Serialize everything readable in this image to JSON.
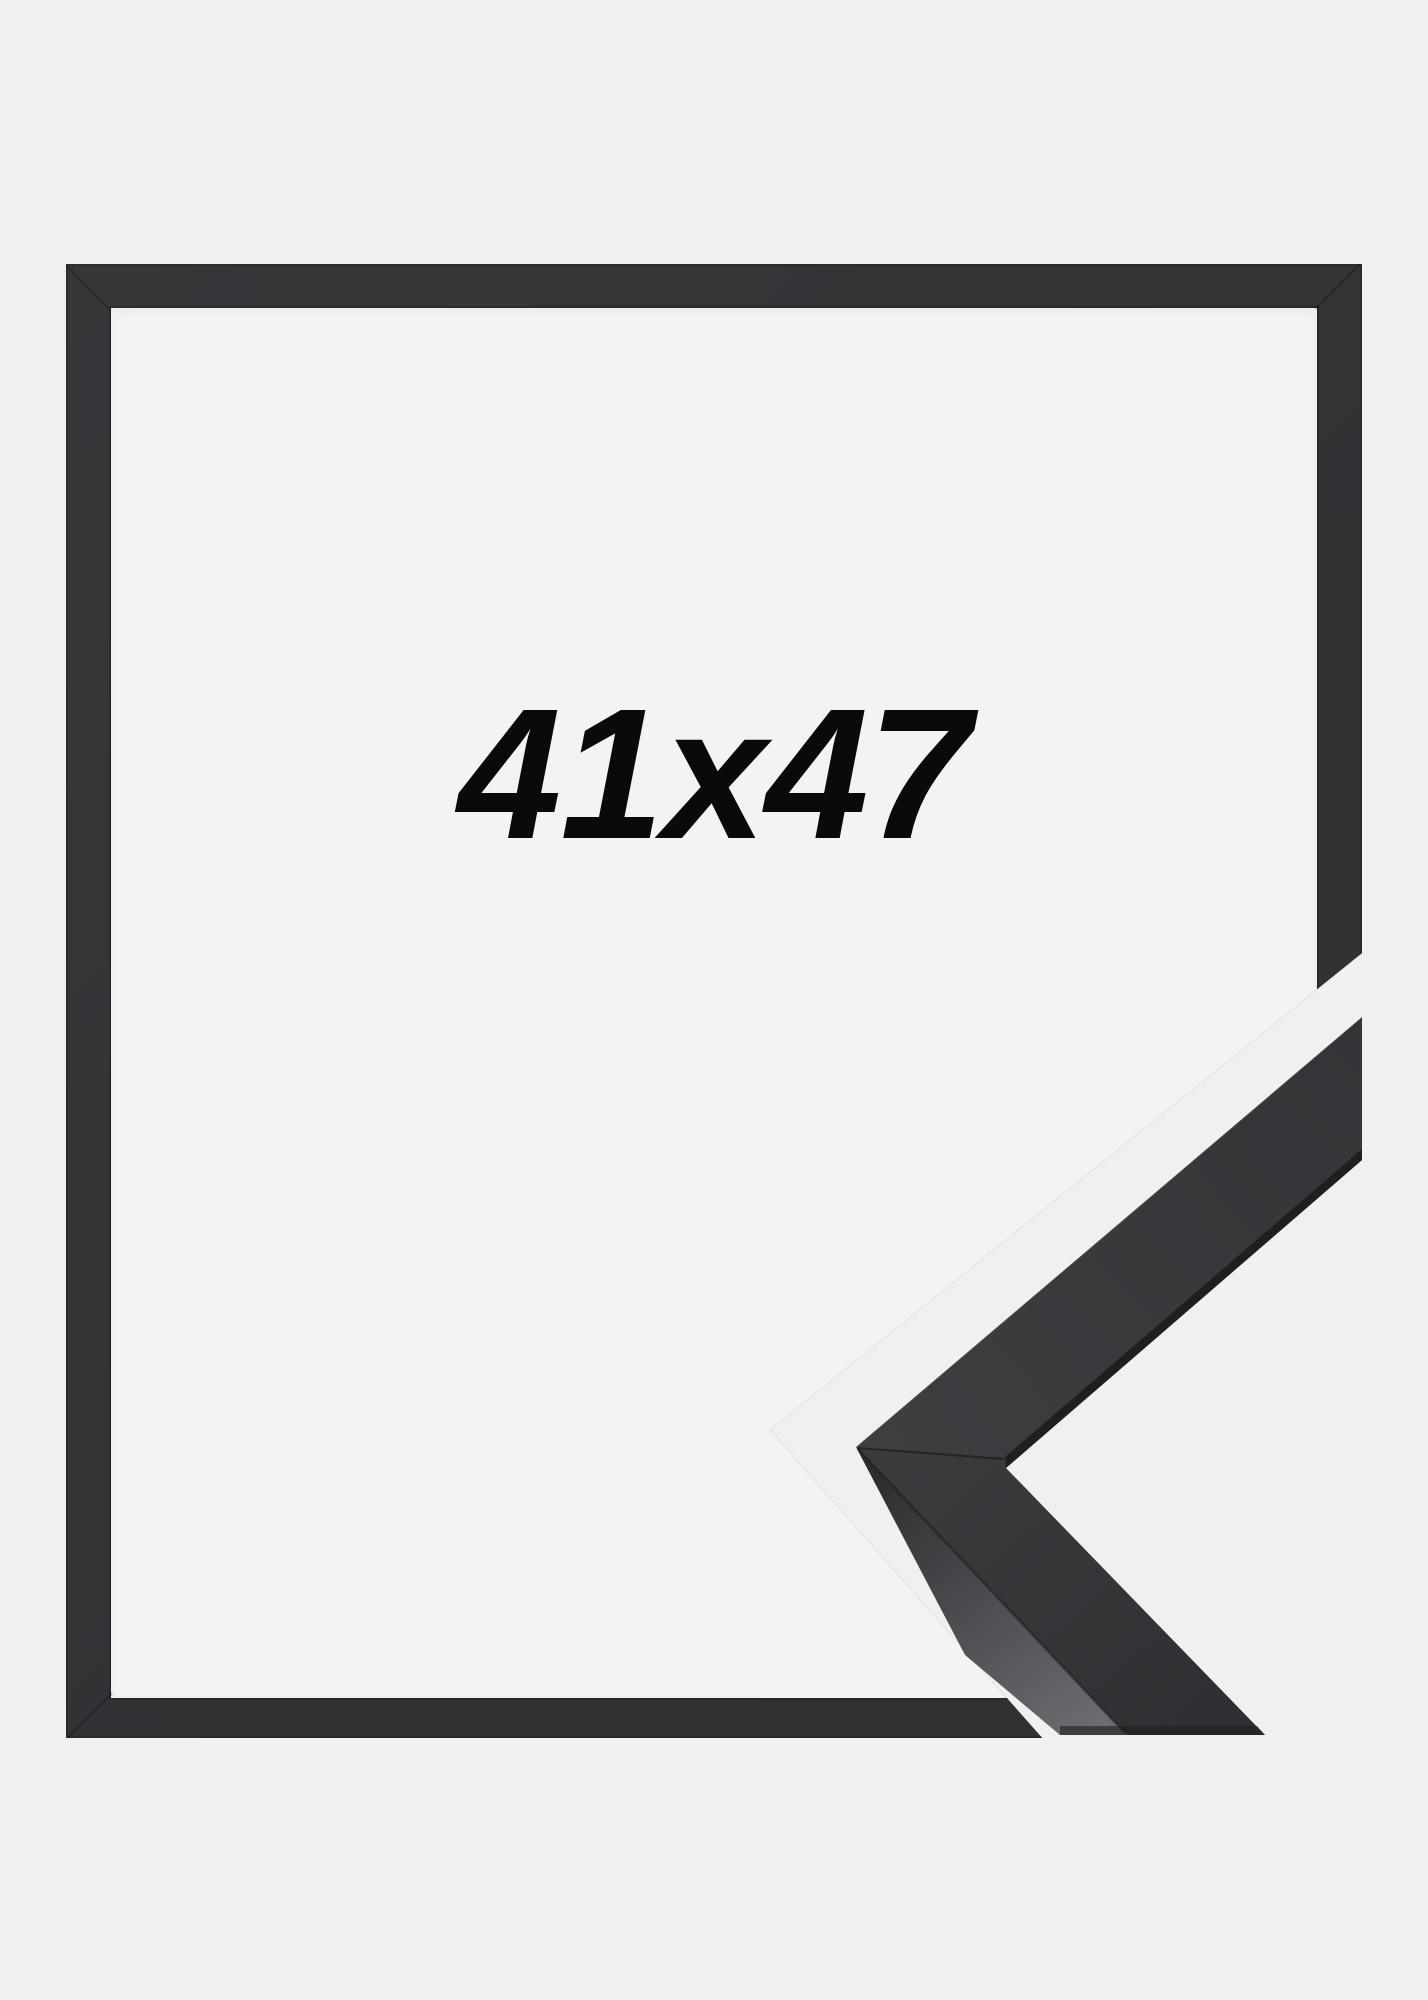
{
  "product": {
    "size_label": "41x47"
  },
  "frame": {
    "style": "black-thin-moulding",
    "views": [
      "front-outline",
      "corner-profile-3d"
    ]
  },
  "theme": {
    "bg": "#f0f0f1",
    "opening-bg": "#f3f3f4",
    "frame-color": "#333336",
    "frame-face": "#39393c",
    "frame-face-dark": "#2f3033",
    "frame-side": "#6b6b70",
    "edge-dark": "#1d1d20",
    "label-color": "#0a0a0b"
  }
}
